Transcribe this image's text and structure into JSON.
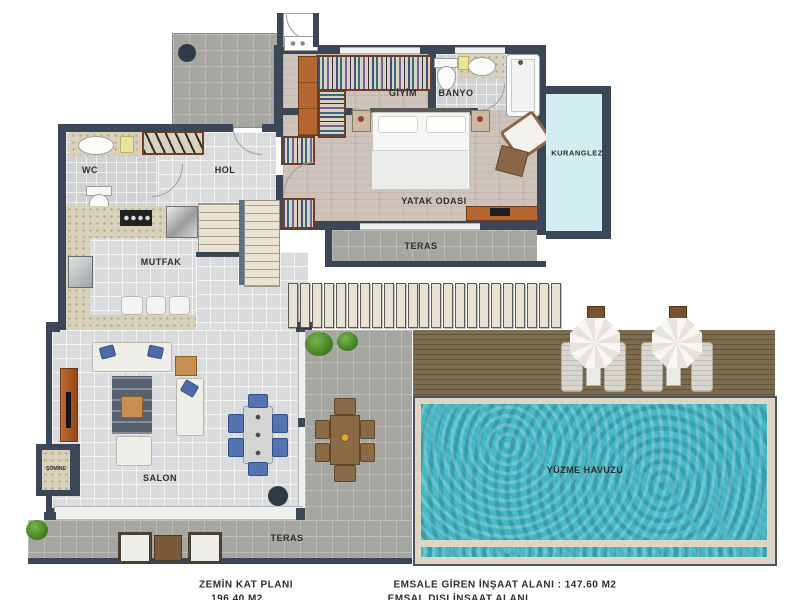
{
  "labels": {
    "wc": "WC",
    "hol": "HOL",
    "mutfak": "MUTFAK",
    "salon": "SALON",
    "giyim": "GİYİM",
    "banyo": "BANYO",
    "yatak_odasi": "YATAK ODASI",
    "teras_ust": "TERAS",
    "teras_alt": "TERAS",
    "kuranglez": "KURANGLEZ",
    "somine": "ŞÖMİNE",
    "havuz": "YÜZME HAVUZU"
  },
  "footer": {
    "plan_title": "ZEMİN KAT PLANI",
    "plan_area": "196.40 M2",
    "right_line1": "EMSALE GİREN İNŞAAT ALANI : 147.60 M2",
    "right_line2": "EMSAL DIŞI İNŞAAT ALANI"
  },
  "pergola": {
    "count": 23,
    "spacing": 11.95
  },
  "colors": {
    "wall": "#3b4756",
    "pool_water": "#3fb4c2",
    "kuranglez_fill": "#d2eef0",
    "deck_wood": "#7d6c4c",
    "dining_chair_blue": "#5272b0",
    "terracotta": "#b5652f"
  }
}
